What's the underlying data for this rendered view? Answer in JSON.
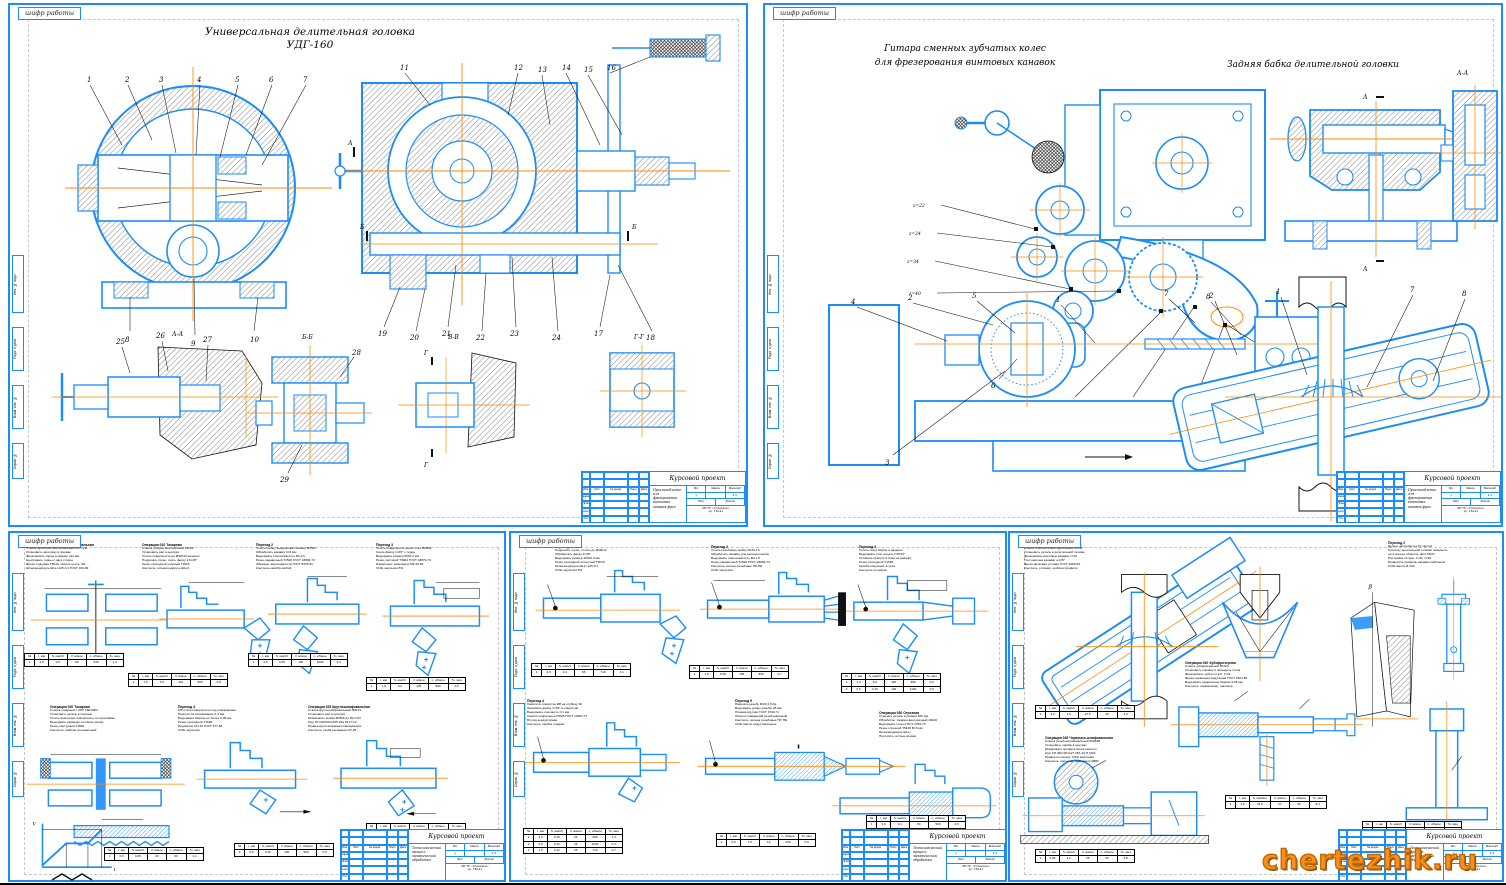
{
  "page": {
    "watermark": "chertezhik.ru"
  },
  "frame_label": "шифр работы",
  "frame_cols": [
    "Инв. № подл.",
    "Подп. и дата",
    "Взам. инв. №",
    "Справ. №"
  ],
  "title_block": {
    "project": "Курсовой проект",
    "desc_top": "Приспособление для фрезерования винтовых канавок фрез",
    "desc_bottom": "Технологический процесс механической обработки",
    "cols": [
      "Изм.",
      "Лист",
      "№ докум.",
      "Подп.",
      "Дата"
    ],
    "roles": [
      "Разраб.",
      "Пров.",
      "Т.контр.",
      "Н.контр.",
      "Утв."
    ],
    "lit_label": "Лит.",
    "mass_label": "Масса",
    "scale_label": "Масштаб",
    "lit_val": "у",
    "scale_val": "1:1",
    "sheet_label": "Лист",
    "sheets_label": "Листов",
    "org": "МГТУ «Станкин»\nгр. ТМ-41"
  },
  "sheet1": {
    "title_line1": "Универсальная делительная головка",
    "title_line2": "УДГ-160",
    "callouts_left_top": [
      "1",
      "2",
      "3",
      "4",
      "5",
      "6",
      "7"
    ],
    "callouts_left_bottom": [
      "8",
      "9",
      "10"
    ],
    "callouts_right_top": [
      "11",
      "12",
      "13",
      "14",
      "15",
      "16"
    ],
    "callouts_right_bottom": [
      "19",
      "20",
      "21",
      "22",
      "23",
      "24",
      "17",
      "18"
    ],
    "detail1_nums": [
      "25",
      "26",
      "27"
    ],
    "detail2_nums": [
      "28",
      "29"
    ],
    "detail1_label": "А-А",
    "detail2_label": "Б-Б",
    "detail3_label": "В-В",
    "detail4_label": "Г-Г",
    "section_marks": [
      "А",
      "Б",
      "В",
      "Г"
    ]
  },
  "sheet2": {
    "title_line1": "Гитара сменных зубчатых колес",
    "title_line2": "для фрезерования винтовых канавок",
    "title_right": "Задняя бабка делительной головки",
    "section_label": "А-А",
    "section_mark": "А",
    "gear_labels": [
      "z=22",
      "z=24",
      "z=34",
      "z=40",
      "z=46",
      "z=40",
      "z=48"
    ],
    "note_label": "болт натяжной",
    "setup_callouts": [
      "4",
      "2",
      "5",
      "1",
      "7",
      "8",
      "3",
      "6"
    ],
    "fixture_callouts": [
      "2",
      "1",
      "7",
      "8"
    ]
  },
  "sheet3": {
    "graph": {
      "ylabel": "V",
      "xlabel": "t"
    },
    "ops": [
      {
        "title": "Операция 005 Фрезерно-центровальная",
        "body": "Станок фрезерно-центровальный МР-71М\nУстановить заготовку в призмы\nФрезеровать торцы в размер 212 мм\nЦентровать торцы с двух сторон\nФреза торцовая Т5К10, сверло центр. Ø4\nШтангенциркуль ШЦ-I-125-0,1 ГОСТ 166-89"
      },
      {
        "title": "Операция 010 Токарная",
        "body": "Станок токарно-винторезный 16К20\nУстановить вал в центрах\nТочить поверхность до Ø32h12 начерно\nПодрезать торец, снять фаску 1,6×45°\nРезец проходной упорный Т15К6\nКонтроль: штангенциркуль ШЦ-II"
      },
      {
        "title": "Переход 2",
        "body": "Точить шейку, выдерживая размер Ø25к6\nОбработать канавку b=3 мм\nВыдержать шероховатость Ra 2,5\nРезец канавочный Т15К6 ГОСТ 18884-73\nОбразцы шероховатости ГОСТ 9378-93\nКонтроль калибр-скобой"
      },
      {
        "title": "Переход 3",
        "body": "Точить поверхность начисто до Ø28h9\nСнять фаску 1×45° с торца\nВыдержать размер 56±0,2 мм\nРезец чистовой Т30К4 ГОСТ 18879-73\nИзмерение: микрометр МК 25-50\nСОЖ эмульсия 5%"
      },
      {
        "title": "Операция 020 Токарная",
        "body": "Станок токарный с ЧПУ 16К20Ф3\nУстановить деталь в патроне\nТочить фасонную поверхность по программе\nВыдержать размеры согласно эскизу\nРезец контурный Т15К6\nКонтроль: шаблон специальный"
      },
      {
        "title": "Переход 4",
        "body": "Обточить поверхность под шлифование\nПрипуск на шлифование 0,3 мм\nВыдержать биение не более 0,05 мм\nРезец проходной Т15К6\nИндикатор ИЧ-10 ГОСТ 577-68\nСОЖ эмульсия"
      },
      {
        "title": "Операция 025 Круглошлифовальная",
        "body": "Станок круглошлифовальный 3М131\nУстановить вал в центрах\nШлифовать шейки Ø25к6 до Ra 0,63\nКруг ПП 600×63×305 24А 25-П С2\nПравка круга алмазным карандашом\nКонтроль: скоба рычажная СР-25"
      }
    ],
    "tables": [
      {
        "headers": [
          "№",
          "t, мм",
          "S, мм/об",
          "V, м/мин",
          "n, об/мин",
          "То, мин"
        ],
        "rows": [
          [
            "1",
            "2,5",
            "0,5",
            "90",
            "630",
            "1,2"
          ]
        ]
      },
      {
        "headers": [
          "№",
          "t, мм",
          "S, мм/об",
          "V, м/мин",
          "n, об/мин",
          "То, мин"
        ],
        "rows": [
          [
            "1",
            "1,5",
            "0,3",
            "110",
            "800",
            "0,8"
          ]
        ]
      },
      {
        "headers": [
          "№",
          "t, мм",
          "S, мм/об",
          "V, м/мин",
          "n, об/мин",
          "То, мин"
        ],
        "rows": [
          [
            "1",
            "0,5",
            "0,25",
            "140",
            "1000",
            "0,4"
          ]
        ]
      },
      {
        "headers": [
          "№",
          "t, мм",
          "S, мм/об",
          "V, м/мин",
          "n, об/мин",
          "То, мин"
        ],
        "rows": [
          [
            "1",
            "1,0",
            "0,2",
            "125",
            "900",
            "0,6"
          ]
        ]
      },
      {
        "headers": [
          "№",
          "t, мм",
          "S, мм/об",
          "V, м/мин",
          "n, об/мин",
          "То, мин"
        ],
        "rows": [
          [
            "1",
            "0,3",
            "0,05",
            "30",
            "63",
            "2,1"
          ]
        ]
      },
      {
        "headers": [
          "№",
          "t, мм",
          "S, мм/об",
          "V, м/мин",
          "n, об/мин",
          "То, мин"
        ],
        "rows": [
          [
            "1",
            "0,8",
            "0,15",
            "120",
            "950",
            "0,5"
          ]
        ]
      },
      {
        "headers": [
          "№",
          "t, мм",
          "S, мм/об",
          "V, м/мин",
          "n, об/мин",
          "То, мин"
        ],
        "rows": [
          [
            "1",
            "0,2",
            "0,04",
            "35",
            "170",
            "1,6"
          ]
        ]
      }
    ]
  },
  "sheet4": {
    "ops": [
      {
        "title": "Переход 1",
        "body": "Подрезать торец, точить до Ø30h12\nОбработать фаску 2×45°\nВыдержать размер 184±0,3 мм\nРезец проходной отогнутый Т5К10\nШтангенциркуль ШЦ-I-125-0,1\nСОЖ эмульсия 5%"
      },
      {
        "title": "Переход 2",
        "body": "Точить резьбовую шейку М16×1,5\nОбработать канавку для выхода резьбы\nВыдержать шероховатость Ra 2,5\nРезец канавочный Т15К6 ГОСТ 18884-73\nКонтроль: кольцо резьбовое ПР-НЕ\nСОЖ эмульсия"
      },
      {
        "title": "Переход 3",
        "body": "Точить конус Морзе 2 начерно\nВыдержать угол конуса 1°25'43\"\nОставить припуск 0,3 мм на доводку\nРезец проходной Т15К6\nКалибр конусный, втулка\nКонтроль по краске"
      },
      {
        "title": "Переход 4",
        "body": "Сверлить отверстие Ø8 на глубину 40\nЗенковать фаску 1×45° в отверстии\nВыдержать соосность 0,1 мм\nСверло спиральное Р6М5 ГОСТ 10903-77\nВтулка кондукторная\nКонтроль: пробка гладкая"
      },
      {
        "title": "Переход 5",
        "body": "Нарезать резьбу М16×1,5-6g\nВыдержать длину резьбы 28 мм\nПлашка круглая ГОСТ 9740-71\nПатрон плавающий резьбонарезной\nКонтроль: кольца резьбовые ПР, НЕ\nСОЖ масло индустриальное"
      },
      {
        "title": "Операция 030 Отрезная",
        "body": "Отрезать деталь в размер 180 мм\nОбработка: токарно-винторезный 16К20\nВыдержать торец ГОСТ 2789-73\nРезец отрезной Т5К10 В=3 мм\nШтангенциркуль ШЦ-I\nПритупить острые кромки"
      }
    ],
    "tables": [
      {
        "headers": [
          "№",
          "t, мм",
          "S, мм/об",
          "V, м/мин",
          "n, об/мин",
          "То, мин"
        ],
        "rows": [
          [
            "1",
            "2,0",
            "0,4",
            "95",
            "710",
            "1,1"
          ]
        ]
      },
      {
        "headers": [
          "№",
          "t, мм",
          "S, мм/об",
          "V, м/мин",
          "n, об/мин",
          "То, мин"
        ],
        "rows": [
          [
            "1",
            "1,5",
            "0,25",
            "105",
            "860",
            "0,7"
          ]
        ]
      },
      {
        "headers": [
          "№",
          "t, мм",
          "S, мм/об",
          "V, м/мин",
          "n, об/мин",
          "То, мин"
        ],
        "rows": [
          [
            "1",
            "1,0",
            "0,2",
            "118",
            "980",
            "0,9"
          ],
          [
            "2",
            "0,5",
            "0,15",
            "126",
            "1100",
            "0,5"
          ]
        ]
      },
      {
        "headers": [
          "№",
          "t, мм",
          "S, мм/об",
          "V, м/мин",
          "n, об/мин",
          "То, мин"
        ],
        "rows": [
          [
            "1",
            "4,0",
            "0,15",
            "24",
            "950",
            "1,3"
          ],
          [
            "2",
            "0,5",
            "0,10",
            "26",
            "1000",
            "0,4"
          ],
          [
            "3",
            "1,5",
            "0,12",
            "25",
            "710",
            "0,7"
          ]
        ]
      },
      {
        "headers": [
          "№",
          "t, мм",
          "S, мм/об",
          "V, м/мин",
          "n, об/мин",
          "То, мин"
        ],
        "rows": [
          [
            "1",
            "0,9",
            "1,5",
            "12",
            "240",
            "0,6"
          ]
        ]
      },
      {
        "headers": [
          "№",
          "t, мм",
          "S, мм/об",
          "V, м/мин",
          "n, об/мин",
          "То, мин"
        ],
        "rows": [
          [
            "1",
            "3,0",
            "0,1",
            "60",
            "560",
            "0,9"
          ]
        ]
      }
    ]
  },
  "sheet5": {
    "ops": [
      {
        "title": "Операция 035 Фрезерная",
        "body": "Станок горизонтально-фрезерный 6Р82Г\nУстановить деталь в делительной головке\nФрезеровать винтовые канавки z=10\nУгол наклона канавки ω=25°\nФреза дисковая угловая ГОСТ 6469-69\nКонтроль: угломер, шаблон профиля"
      },
      {
        "title": "Переход 2",
        "body": "Делить заготовку на 10 частей\nРукоятку делительной головки повернуть\nна 4 полных оборота, диск 54/27\nНастройка гитары: z=40, z=48\nПроверить профиль канавки шаблоном\nСОЖ масло И-20А"
      },
      {
        "title": "Операция 040 Зубофрезерная",
        "body": "Станок зубофрезерный 5К32А\nУстановить оправку в шпиндель стола\nФрезеровать зубья m=2,5; z=32\nФреза червячная модульная ГОСТ 9324-80\nВыдержать радиальное биение 0,05 мм\nКонтроль: нормалемер, шагомер"
      },
      {
        "title": "Операция 045 Червячно-шлифовальная",
        "body": "Станок резьбошлифовальный 5К822В\nУстановить червяк в центрах\nШлифовать профиль витка начисто\nКруг 2П 400×20×127 25А 16-П СМ2\nПравка по копиру, СОЖ масляная\nКонтроль: проектор, микрометр МВМ"
      }
    ],
    "tables": [
      {
        "headers": [
          "№",
          "t, мм",
          "S, мм/об",
          "V, м/мин",
          "n, об/мин",
          "То, мин"
        ],
        "rows": [
          [
            "1",
            "3,2",
            "1,6",
            "27,5",
            "40",
            "4,2"
          ]
        ]
      },
      {
        "headers": [
          "№",
          "t, мм",
          "S, мм/об",
          "V, м/мин",
          "n, об/мин",
          "То, мин"
        ],
        "rows": [
          [
            "1",
            "0,05",
            "1,2",
            "35",
            "63",
            "6,8"
          ]
        ]
      },
      {
        "headers": [
          "№",
          "t, мм",
          "S, мм/мин",
          "V, м/мин",
          "n, об/мин",
          "То, мин"
        ],
        "rows": [
          [
            "1",
            "2,5",
            "31,5",
            "27",
            "56",
            "8,4"
          ]
        ]
      },
      {
        "headers": [
          "№",
          "t, мм",
          "S, мм/об",
          "V, м/мин",
          "n, об/мин",
          "То, мин"
        ],
        "rows": [
          [
            "1",
            "0,1",
            "0,4",
            "30",
            "95",
            "3,2"
          ]
        ]
      }
    ]
  }
}
